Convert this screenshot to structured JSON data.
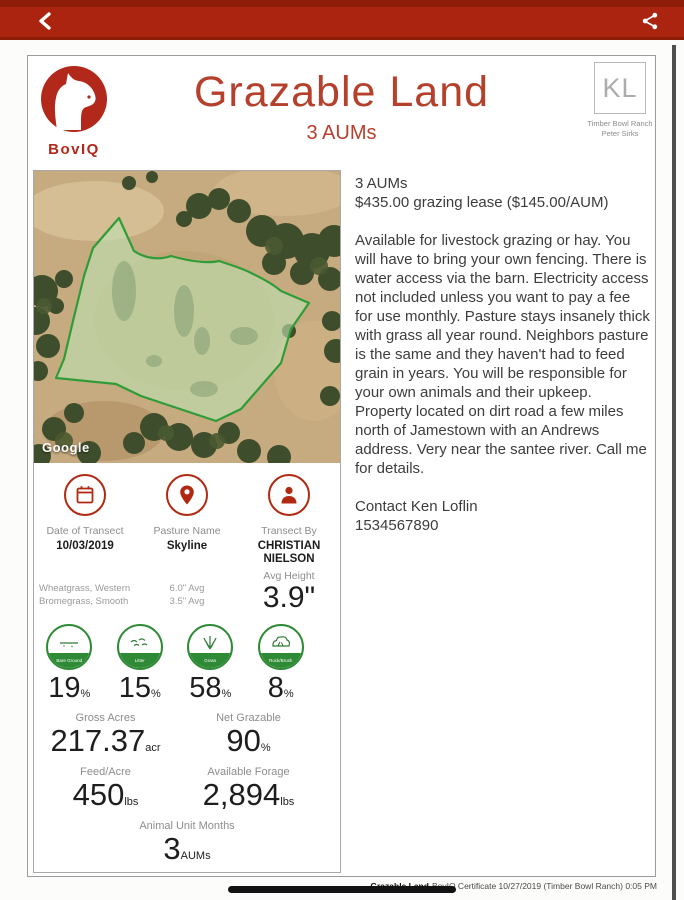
{
  "colors": {
    "appbar_red": "#aa2410",
    "brand_red": "#b2281a",
    "title_red": "#b5402c",
    "icon_red": "#b02a12",
    "badge_green": "#2f8a35",
    "polygon_green": "#2f9c38"
  },
  "header": {
    "brand": "BovIQ",
    "title": "Grazable Land",
    "subtitle": "3 AUMs",
    "ranch_logo": "KL",
    "ranch_name": "Timber Bowl Ranch",
    "ranch_owner": "Peter Sirks"
  },
  "map": {
    "attribution": "Google"
  },
  "transect": {
    "date_label": "Date of Transect",
    "date": "10/03/2019",
    "pasture_label": "Pasture Name",
    "pasture": "Skyline",
    "by_label": "Transect By",
    "by_name": "CHRISTIAN NIELSON",
    "species_line1": "Wheatgrass, Western",
    "species_line2": "Bromegrass, Smooth",
    "avg1": "6.0\" Avg",
    "avg2": "3.5\" Avg",
    "avg_height_label": "Avg Height",
    "avg_height": "3.9\""
  },
  "composition": [
    {
      "label": "Bare Ground",
      "value": "19",
      "unit": "%"
    },
    {
      "label": "Litter",
      "value": "15",
      "unit": "%"
    },
    {
      "label": "Grass",
      "value": "58",
      "unit": "%"
    },
    {
      "label": "Rock/Brush",
      "value": "8",
      "unit": "%"
    }
  ],
  "metrics": {
    "gross_acres_label": "Gross Acres",
    "gross_acres": "217.37",
    "gross_acres_unit": "acr",
    "net_grazable_label": "Net Grazable",
    "net_grazable": "90",
    "net_grazable_unit": "%",
    "feed_acre_label": "Feed/Acre",
    "feed_acre": "450",
    "feed_acre_unit": "lbs",
    "forage_label": "Available Forage",
    "forage": "2,894",
    "forage_unit": "lbs",
    "aum_label": "Animal Unit Months",
    "aum": "3",
    "aum_unit": "AUMs"
  },
  "listing": {
    "aums": "3 AUMs",
    "price": "$435.00 grazing lease ($145.00/AUM)",
    "description": "Available for livestock grazing or hay. You will have to bring your own fencing. There is water access via the barn. Electricity access not included unless you want to pay a fee for use monthly. Pasture stays insanely thick with grass all year round. Neighbors pasture is the same and they haven't had to feed grain in years. You will be responsible for your own animals and their upkeep. Property located on dirt road a few miles north of Jamestown with an Andrews address. Very near the santee river. Call me for details.",
    "contact": "Contact Ken Loflin",
    "phone": "1534567890"
  },
  "footer": {
    "doc_title": "Grazable Land",
    "certificate": "BovIQ Certificate 10/27/2019 (Timber Bowl Ranch) 0:05 PM"
  }
}
